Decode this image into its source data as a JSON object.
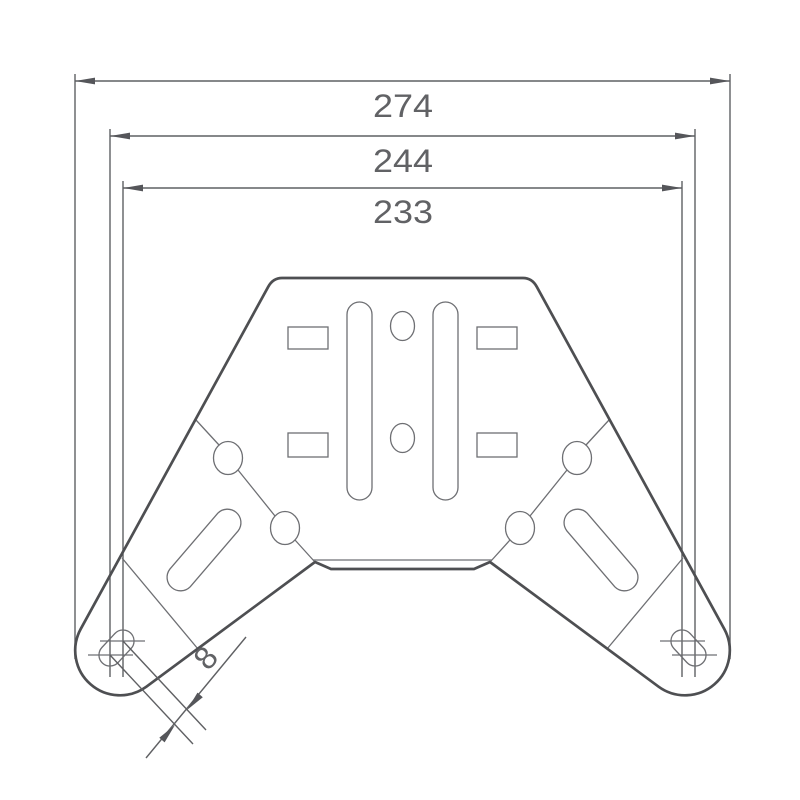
{
  "page": {
    "background": "#ffffff"
  },
  "drawing": {
    "dimensions": {
      "overall_width": {
        "value": "274"
      },
      "outer_slot_span": {
        "value": "244"
      },
      "inner_slot_span": {
        "value": "233"
      },
      "end_slot_spacing": {
        "value": "8"
      }
    },
    "colors": {
      "outline": "#4e4f52",
      "thin_line": "#6e6f73",
      "dimension_line": "#5f6063",
      "arrow": "#55565a",
      "text": "#616265"
    }
  }
}
